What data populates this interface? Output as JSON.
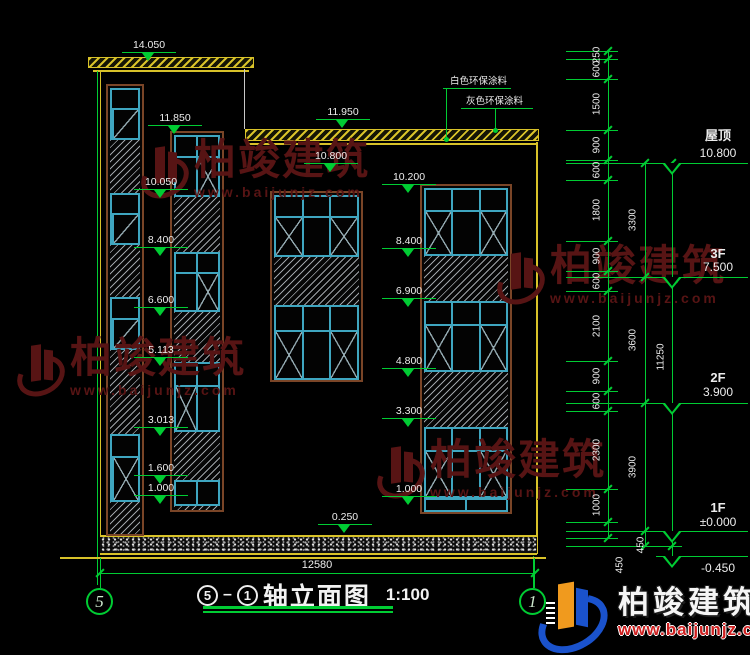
{
  "annotations": {
    "paint_note_white": "白色环保涂料",
    "paint_note_gray": "灰色环保涂料"
  },
  "levels": {
    "l14050": "14.050",
    "l11950": "11.950",
    "l11850": "11.850",
    "l10800_mid": "10.800",
    "l10050": "10.050",
    "l10200": "10.200",
    "l8400_left": "8.400",
    "l8400_right": "8.400",
    "l6600": "6.600",
    "l6900": "6.900",
    "l5113": "5.113",
    "l4800": "4.800",
    "l3013": "3.013",
    "l3300": "3.300",
    "l1600": "1.600",
    "l1000_left": "1.000",
    "l1000_right": "1.000",
    "l0250": "0.250"
  },
  "dims": {
    "chain_inner": [
      "250",
      "600",
      "1500",
      "900",
      "600",
      "1800",
      "900",
      "600",
      "2100",
      "900",
      "600",
      "2300",
      "1000",
      "450"
    ],
    "chain_floor": [
      "3300",
      "3600",
      "3900",
      "450"
    ],
    "overall_height": "11250",
    "overall_width": "12580"
  },
  "floors": {
    "roof_name": "屋顶",
    "roof_level": "10.800",
    "f3_name": "3F",
    "f3_level": "7.500",
    "f2_name": "2F",
    "f2_level": "3.900",
    "f1_name": "1F",
    "f1_level": "±0.000",
    "base_level": "-0.450"
  },
  "titlebar": {
    "axis_left": "5",
    "axis_right": "1",
    "circle_left": "5",
    "circle_right": "1",
    "title": "轴立面图",
    "scale": "1:100"
  },
  "watermark": {
    "name": "柏竣建筑",
    "url": "www.baijunjz.com"
  },
  "brand": {
    "name": "柏竣建筑",
    "url": "www.baijunjz.com"
  },
  "colors": {
    "dim_green": "#00cc33",
    "frame_cyan": "#3fa6c0",
    "surround_brown": "#7a4527",
    "roof_yellow": "#d8c229",
    "watermark_maroon": "#571414",
    "brand_blue": "#1a52cc",
    "brand_orange": "#f09a1e",
    "url_red": "#cf2020"
  }
}
